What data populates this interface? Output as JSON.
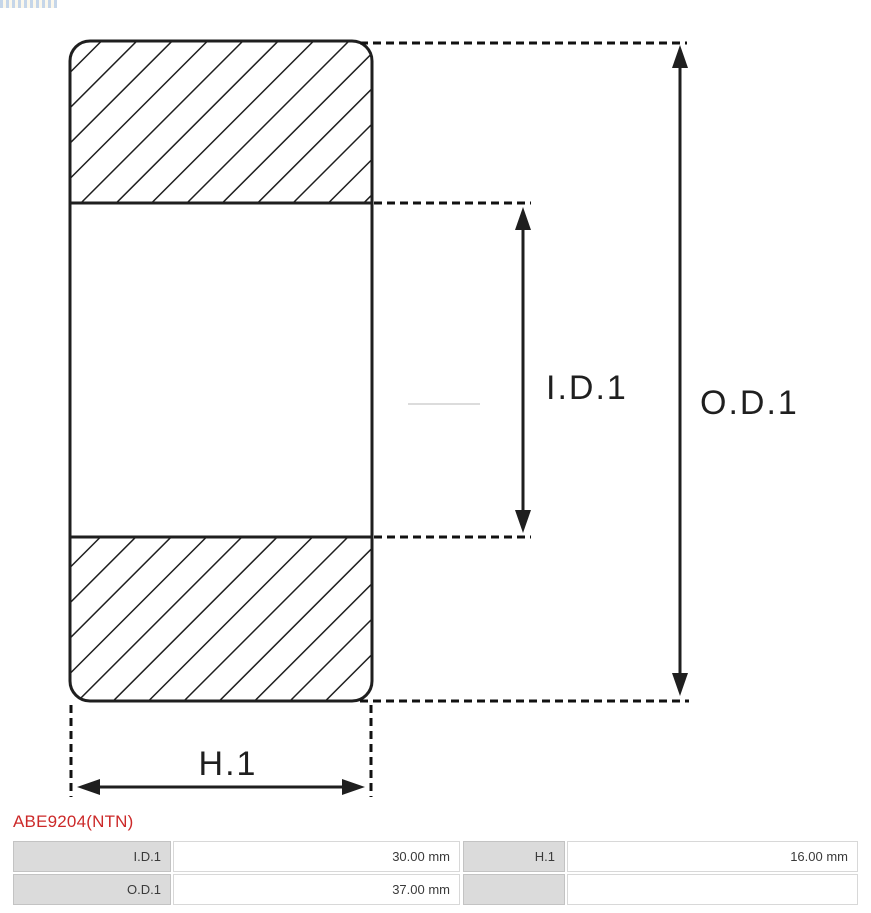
{
  "page": {
    "background": "#ffffff",
    "line_color": "#1f1f1f",
    "accent_color": "#cc2929"
  },
  "part_header": {
    "part_number": "ABE9204(NTN)"
  },
  "diagram": {
    "type": "bearing-cross-section",
    "labels": {
      "inner_diameter": "I.D.1",
      "outer_diameter": "O.D.1",
      "height": "H.1"
    }
  },
  "spec_table": {
    "rows": [
      [
        "I.D.1",
        "30.00 mm",
        "H.1",
        "16.00 mm"
      ],
      [
        "O.D.1",
        "37.00 mm",
        "",
        ""
      ]
    ]
  }
}
